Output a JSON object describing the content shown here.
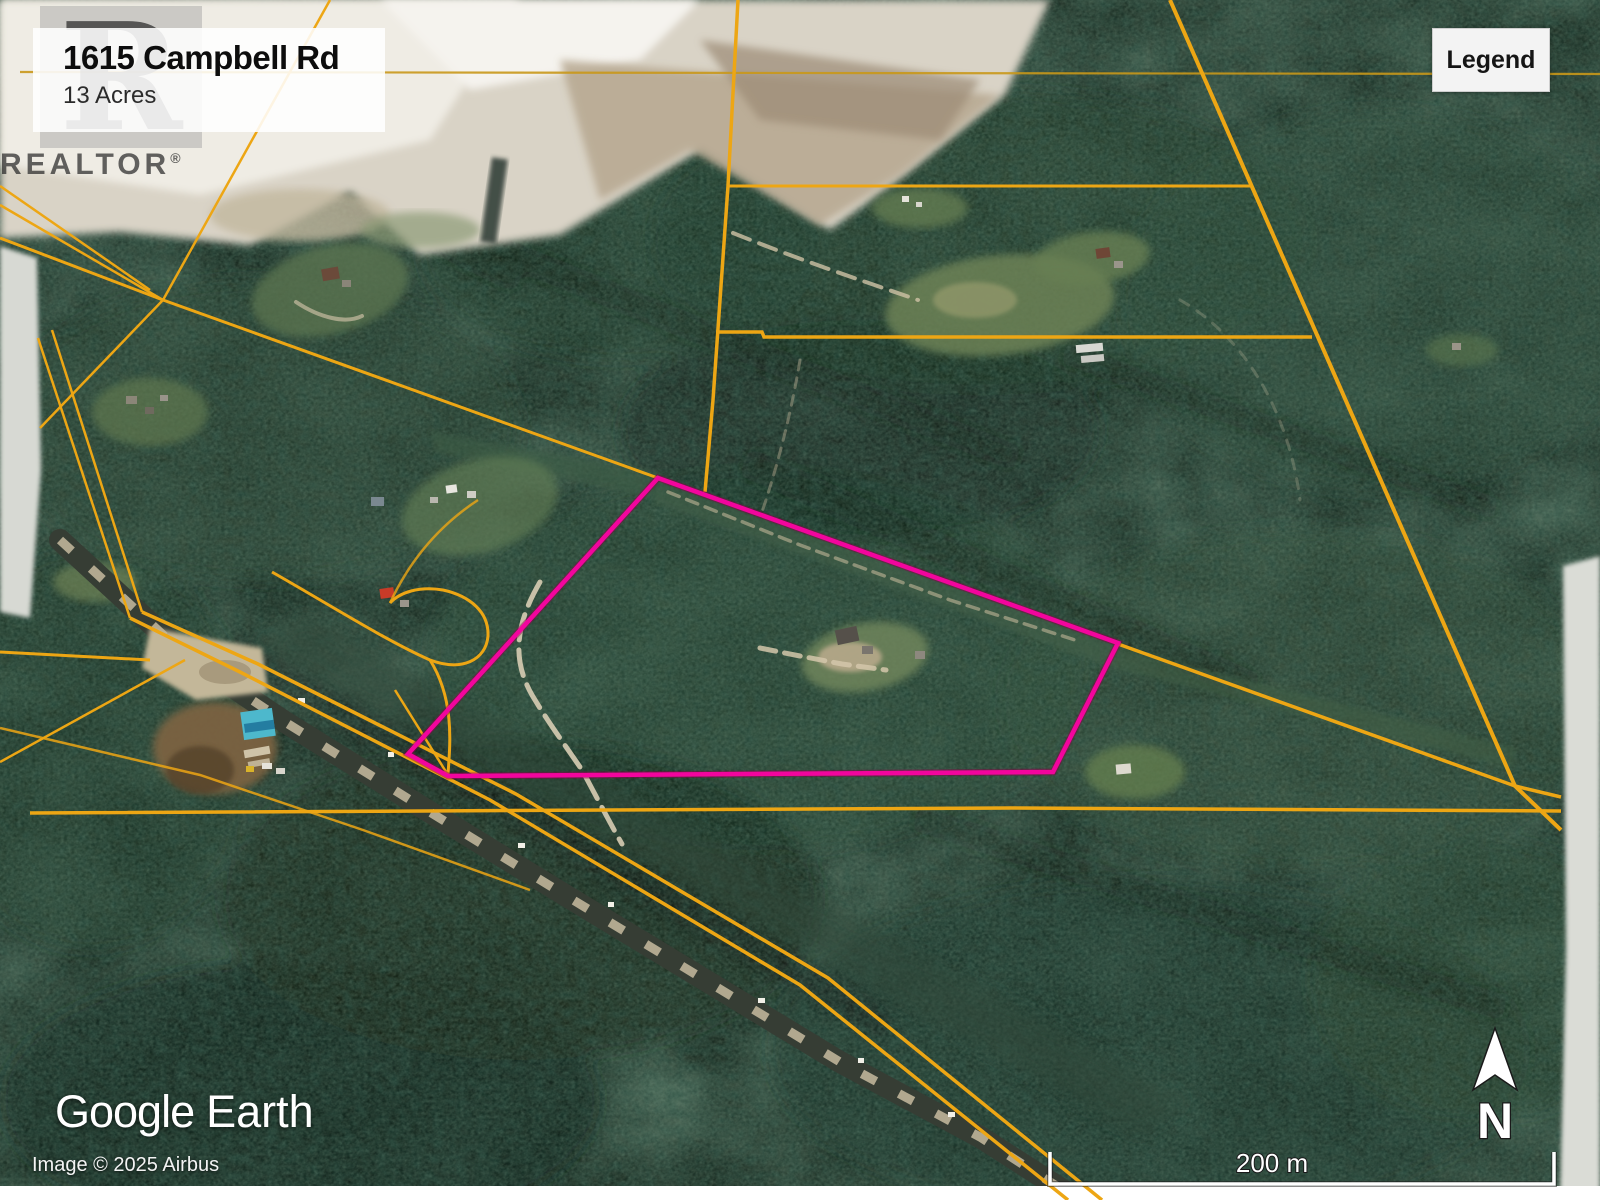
{
  "info_card": {
    "title": "1615 Campbell Rd",
    "subtitle": "13 Acres"
  },
  "legend_button": {
    "label": "Legend"
  },
  "watermark": {
    "letter": "R",
    "brand": "REALTOR",
    "registered": "®"
  },
  "attribution": {
    "google": "Google",
    "earth": "Earth",
    "imagery_credit": "Image © 2025 Airbus"
  },
  "scale_bar": {
    "label": "200 m"
  },
  "compass": {
    "north_label": "N"
  },
  "colors": {
    "parcel_outline": "#F2059D",
    "parcel_outline_glow": "#8a0044",
    "cadastral_line": "#EDA614",
    "cadastral_line_dim": "#C9981A",
    "forest_base": "#1b2b21",
    "edge_strip": "#d8dad4"
  }
}
